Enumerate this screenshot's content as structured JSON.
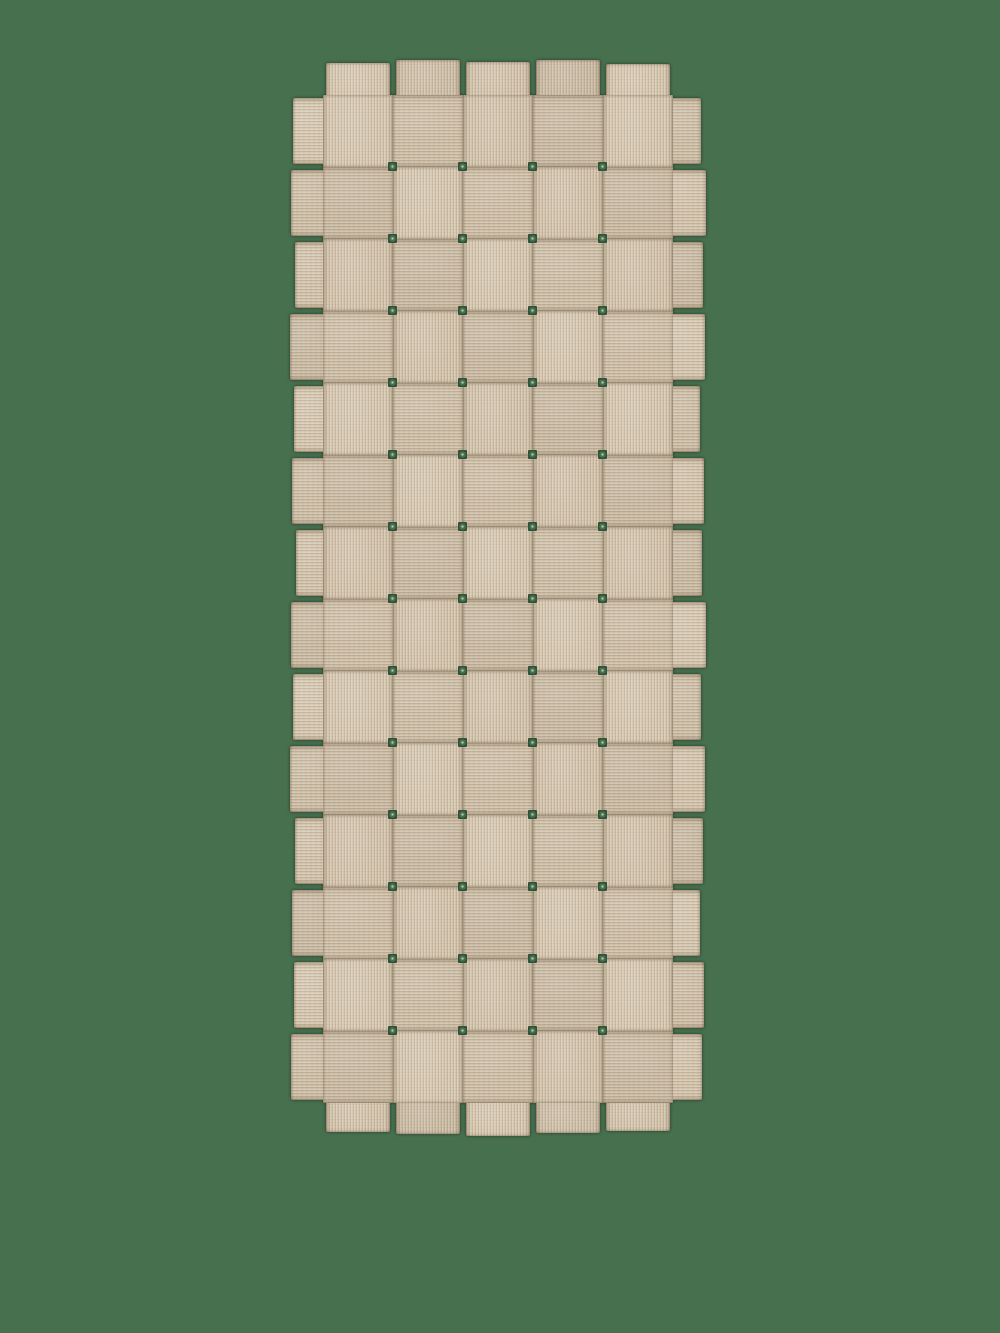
{
  "meta": {
    "description": "Product photograph of a beige basket-weave rug runner made of wide interlaced fabric strips, shown flat on a plain green background. No text, controls or UI elements are visible."
  },
  "scene": {
    "width": 1000,
    "height": 1333,
    "background_color": "#47704F"
  },
  "rug": {
    "left": 293,
    "top": 60,
    "width": 417,
    "height": 1075,
    "weave": {
      "rows": 14,
      "cols": 5,
      "cell_w": 70,
      "cell_h": 72,
      "offset_x": 30,
      "offset_y": 35,
      "top_strip_rule": "vertical strip on top when (row+col) is even, horizontal strip on top when odd"
    },
    "colors": {
      "base": "#d2c3ad",
      "shades": [
        "#d7c9b3",
        "#cfc0aa",
        "#d4c5af",
        "#cbbca6"
      ],
      "seam_shadow": "#5e4a31",
      "hole_ring": "#2f5138",
      "hole_mid": "#44714e",
      "hole_center": "#c9bba4"
    },
    "tabs": {
      "top_lengths": [
        32,
        35,
        33,
        35,
        31
      ],
      "bottom_lengths": [
        29,
        31,
        33,
        30,
        28
      ],
      "left_lengths": [
        30,
        32,
        28,
        33,
        29,
        31,
        27,
        32,
        30,
        33,
        28,
        31,
        29,
        32
      ],
      "right_lengths": [
        28,
        33,
        30,
        32,
        27,
        31,
        29,
        33,
        28,
        32,
        30,
        27,
        31,
        29
      ]
    }
  }
}
